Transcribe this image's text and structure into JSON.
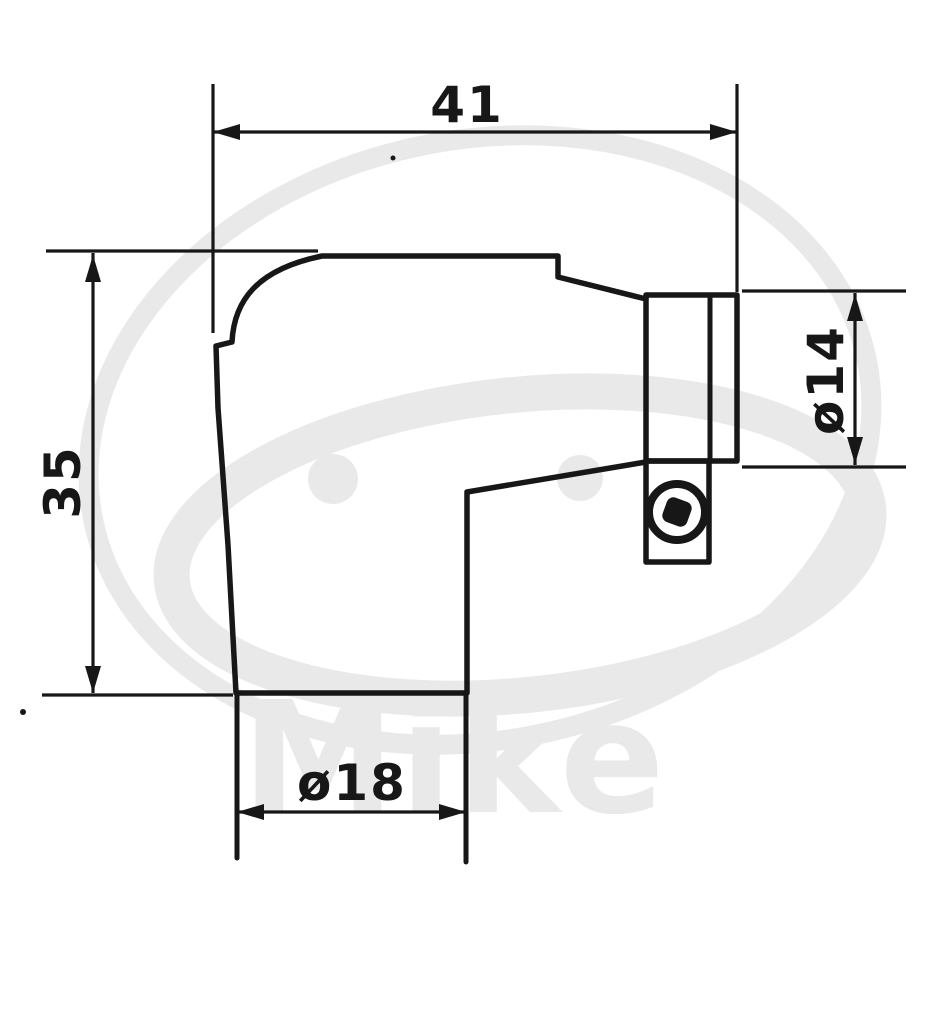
{
  "colors": {
    "ink": "#171717",
    "wm": "#e9e9e9",
    "bg": "#ffffff"
  },
  "drawing": {
    "dimensions": {
      "top_width": {
        "label": "41"
      },
      "left_height": {
        "label": "35"
      },
      "terminal_diameter": {
        "label": "ø14"
      },
      "socket_diameter": {
        "label": "ø18"
      }
    },
    "watermark": {
      "text": "Mike"
    }
  }
}
